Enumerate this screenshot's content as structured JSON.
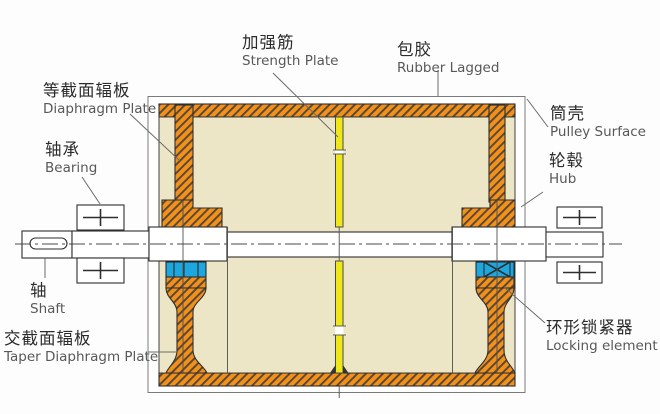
{
  "labels": {
    "strength_plate": {
      "zh": "加强筋",
      "en": "Strength Plate"
    },
    "rubber_lagged": {
      "zh": "包胶",
      "en": "Rubber Lagged"
    },
    "diaphragm_plate": {
      "zh": "等截面辐板",
      "en": "Diaphragm Plate"
    },
    "bearing": {
      "zh": "轴承",
      "en": "Bearing"
    },
    "shaft": {
      "zh": "轴",
      "en": "Shaft"
    },
    "taper_diaphragm_plate": {
      "zh": "交截面辐板",
      "en": "Taper Diaphragm Plate"
    },
    "pulley_surface": {
      "zh": "筒壳",
      "en": "Pulley Surface"
    },
    "hub": {
      "zh": "轮毂",
      "en": "Hub"
    },
    "locking_element": {
      "zh": "环形锁紧器",
      "en": "Locking element"
    }
  },
  "colors": {
    "orange": "#F2901C",
    "cream": "#EDE6C6",
    "yellow": "#EFE818",
    "cyan": "#1EA7DF",
    "line": "#2E2E2E",
    "leader": "#6A6A6A",
    "text_zh": "#2B2B2B",
    "text_en": "#585858",
    "white": "#FFFFFF",
    "bg": "#FDFDFD"
  }
}
